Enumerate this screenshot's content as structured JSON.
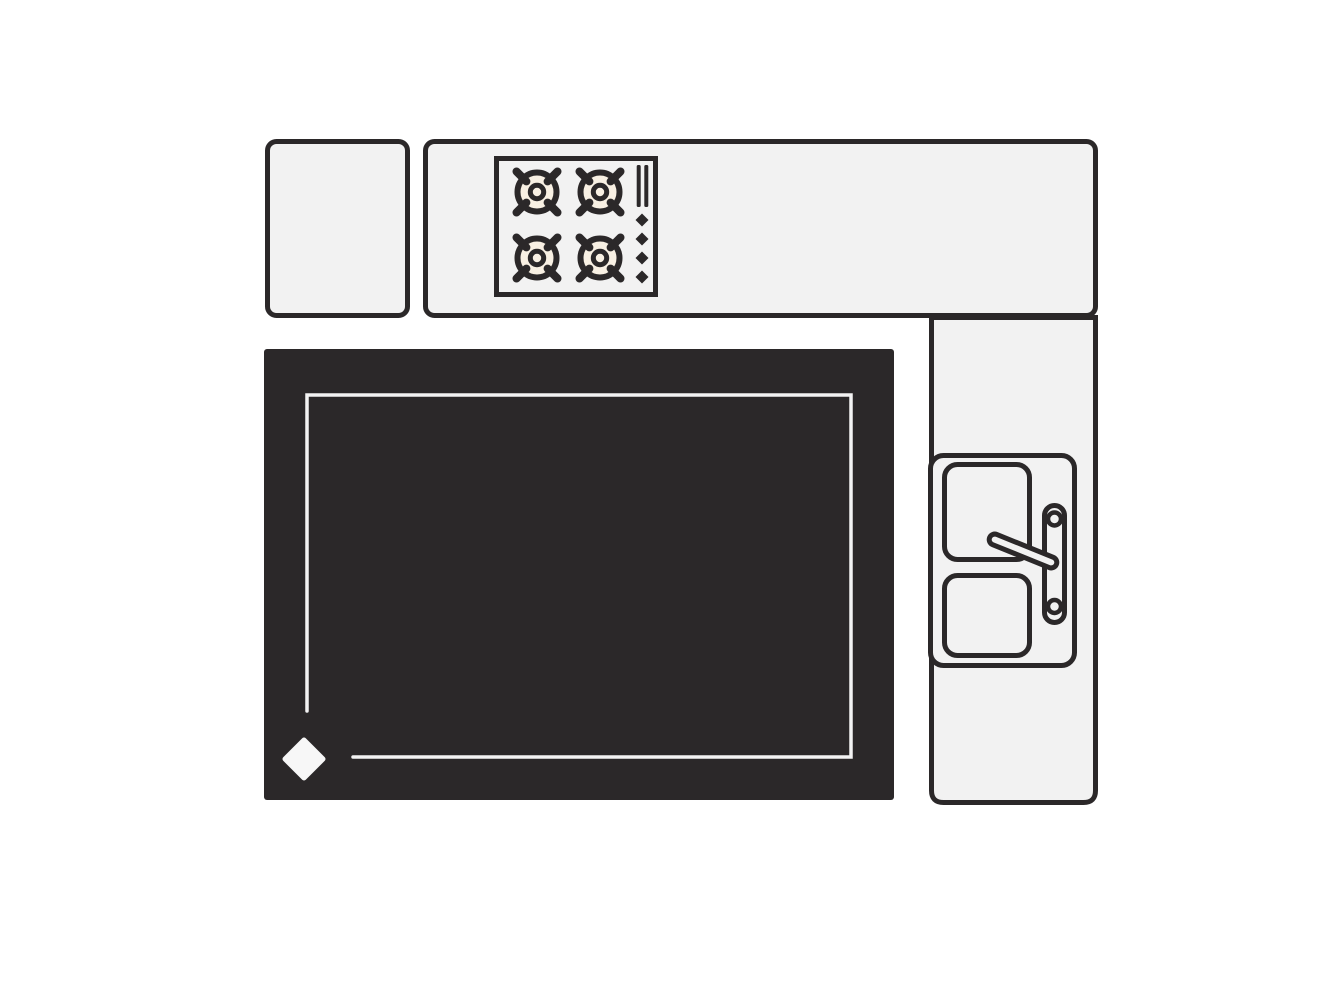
{
  "title": "Kitchen floor plan illustration",
  "canvas": {
    "width": 1334,
    "height": 1000,
    "background": "#ffffff"
  },
  "palette": {
    "surface": "#f2f2f2",
    "outline": "#2b2829",
    "island_fill": "#2b2829",
    "burner_center": "#f8f0e3",
    "inset_line": "#f3f3f3",
    "diamond_marker": "#f7f7f7"
  },
  "furniture": {
    "corner_cabinet": {
      "label": "corner cabinet"
    },
    "upper_counter": {
      "label": "upper counter with cooktop"
    },
    "cooktop": {
      "label": "four-burner cooktop",
      "burners": 4,
      "control_bars": 2,
      "control_diamonds": 4
    },
    "side_counter": {
      "label": "side counter with sink"
    },
    "sink": {
      "label": "double-basin sink with faucet",
      "basins": 2,
      "knobs": 2,
      "faucet_arms": 1
    },
    "island": {
      "label": "kitchen island with inset trim and diamond marker"
    }
  }
}
